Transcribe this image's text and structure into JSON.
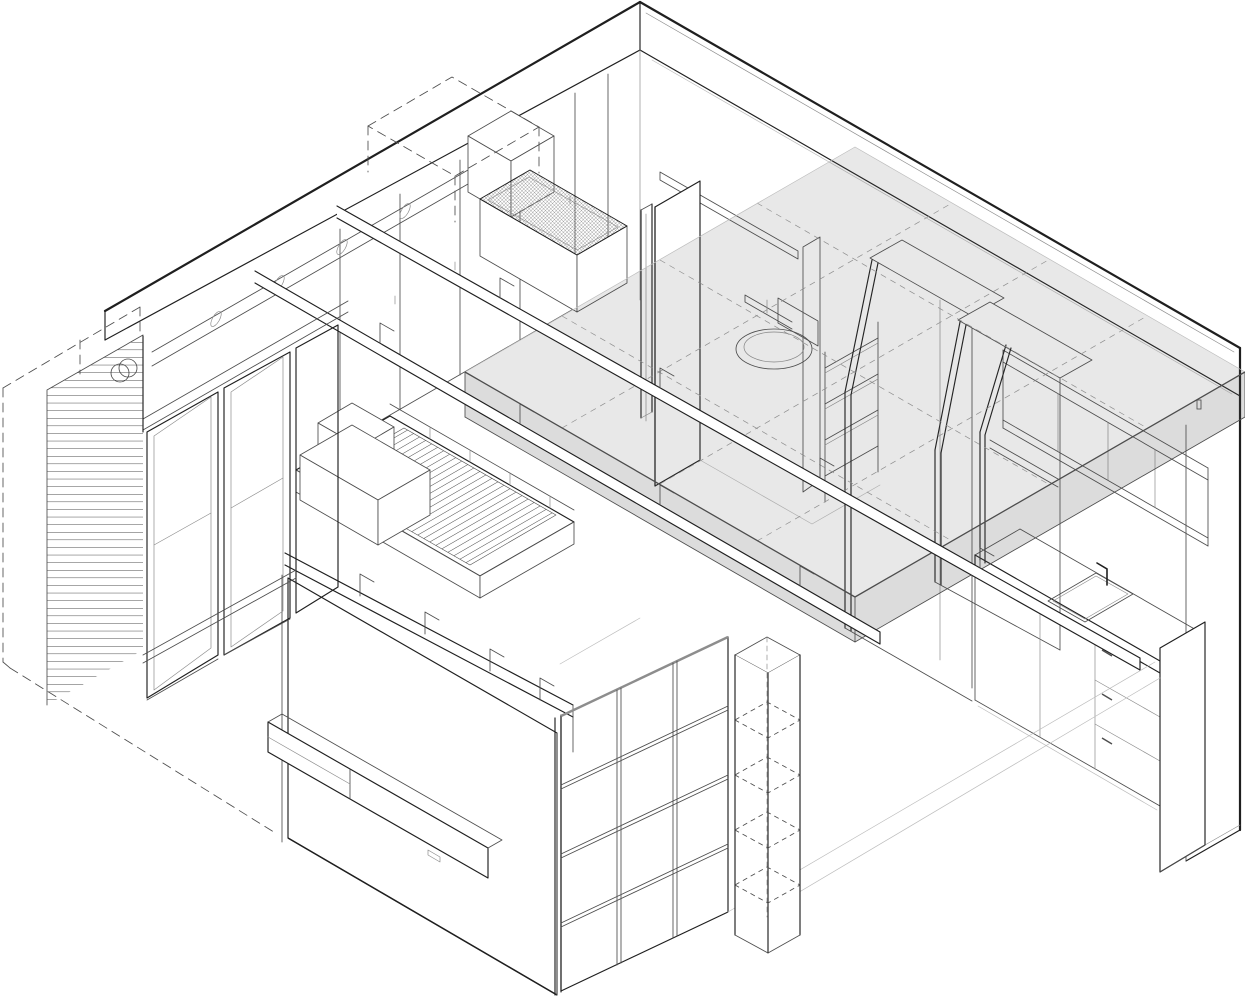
{
  "drawing": {
    "title": "Apartment axonometric",
    "subject": "Axonometric cutaway line drawing of a small studio apartment interior",
    "projection": "isometric 30 degrees",
    "style": "black-and-white technical line drawing with translucent grey mezzanine slab"
  },
  "colors": {
    "background": "#ffffff",
    "ink": "#1f1f1f",
    "mid": "#4d4d4d",
    "light": "#8d8d8d",
    "faint": "#bdbdbd",
    "slab-fill": "rgba(80,80,80,0.13)",
    "slab-face": "rgba(80,80,80,0.20)"
  },
  "elements": [
    {
      "id": "roof-slab",
      "label": "roof slab band with cut-away opening"
    },
    {
      "id": "ac-outdoor-unit-dashed",
      "label": "dashed outdoor AC condenser volume on roof"
    },
    {
      "id": "ac-indoor-unit",
      "label": "indoor AC unit box"
    },
    {
      "id": "duct-pipe",
      "label": "round duct pipe along wardrobe wall top"
    },
    {
      "id": "skylight-grille",
      "label": "cross-hatched skylight / grille panel"
    },
    {
      "id": "wardrobe-wall",
      "label": "back wall floor-to-ceiling wardrobes"
    },
    {
      "id": "bathroom-door",
      "label": "bathroom door frame"
    },
    {
      "id": "overhead-shelf",
      "label": "high shelf over bathroom door"
    },
    {
      "id": "bathroom",
      "label": "bathroom with toilet, cistern and shelving"
    },
    {
      "id": "wardrobe-unit-1",
      "label": "tall sloped-side cabinet unit 1"
    },
    {
      "id": "wardrobe-unit-2",
      "label": "tall sloped-side cabinet unit 2"
    },
    {
      "id": "kitchen",
      "label": "kitchen: upper shelves, counter, sink, cabinets, drawers"
    },
    {
      "id": "mezzanine-slab",
      "label": "translucent mezzanine floor slab with dashed grid"
    },
    {
      "id": "walkway-beams",
      "label": "long double-rail beams with brackets"
    },
    {
      "id": "loft-platform",
      "label": "loft platform with slatted stair surface and storage boxes"
    },
    {
      "id": "tv-wall",
      "label": "living room wall with floating TV console"
    },
    {
      "id": "grid-shelving-wall",
      "label": "square grid shelving wall"
    },
    {
      "id": "dashed-shelf-tower",
      "label": "tall shelf tower with dashed hidden shelves"
    },
    {
      "id": "louver-screen",
      "label": "horizontal louver screen at balcony"
    },
    {
      "id": "sliding-glass-doors",
      "label": "sliding glass doors to balcony"
    },
    {
      "id": "balcony-outline-dashed",
      "label": "dashed balcony volume outline"
    },
    {
      "id": "right-wall",
      "label": "right side wall"
    }
  ]
}
